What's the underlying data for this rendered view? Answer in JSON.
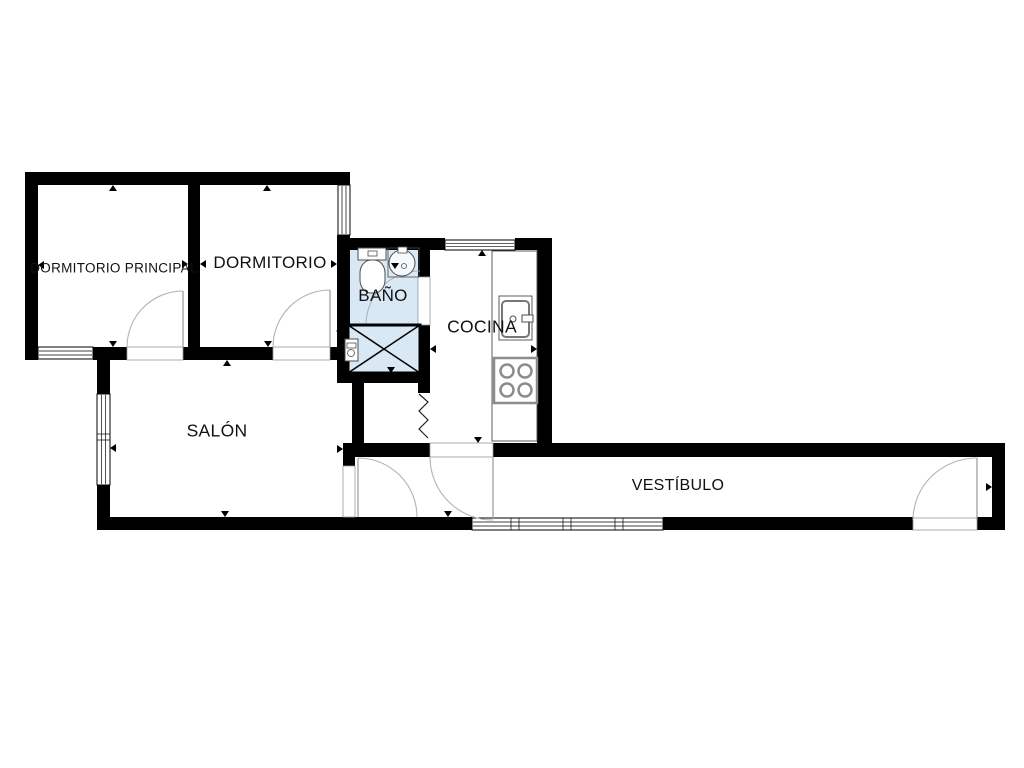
{
  "page": {
    "background": "#ffffff"
  },
  "rooms": [
    {
      "id": "dormitorio-principal",
      "label": "DORMITORIO PRINCIPAL",
      "x": 114,
      "y": 268,
      "font_size": 13.5
    },
    {
      "id": "dormitorio",
      "label": "DORMITORIO",
      "x": 270,
      "y": 263,
      "font_size": 17
    },
    {
      "id": "bano",
      "label": "BAÑO",
      "x": 383,
      "y": 296,
      "font_size": 17
    },
    {
      "id": "cocina",
      "label": "COCINA",
      "x": 482,
      "y": 327,
      "font_size": 17.5
    },
    {
      "id": "salon",
      "label": "SALÓN",
      "x": 217,
      "y": 431,
      "font_size": 17.5
    },
    {
      "id": "vestibulo",
      "label": "VESTÍBULO",
      "x": 678,
      "y": 486,
      "font_size": 16
    }
  ],
  "colors": {
    "wall": "#000000",
    "bath_fill": "#d9e8f5",
    "arc": "#b3b3b3",
    "leaf": "#9a9a9a",
    "fixture": "#4d4d4d",
    "appliance": "#8c8c8c",
    "threshold": "#999999",
    "text": "#111111"
  },
  "floorplan": {
    "width": 1024,
    "height": 768,
    "fills": [
      {
        "x": 347,
        "y": 249,
        "w": 72,
        "h": 125,
        "color": "#d9e8f5",
        "name": "bathroom-floor"
      }
    ],
    "walls": [
      [
        25,
        172,
        325,
        13
      ],
      [
        25,
        172,
        13,
        188
      ],
      [
        25,
        347,
        13,
        13
      ],
      [
        93,
        347,
        34,
        13
      ],
      [
        183,
        347,
        90,
        13
      ],
      [
        330,
        347,
        20,
        13
      ],
      [
        188,
        180,
        12,
        175
      ],
      [
        337,
        235,
        13,
        15
      ],
      [
        337,
        238,
        108,
        12
      ],
      [
        515,
        238,
        37,
        12
      ],
      [
        337,
        250,
        13,
        133
      ],
      [
        418,
        250,
        12,
        27
      ],
      [
        418,
        325,
        12,
        68
      ],
      [
        337,
        373,
        93,
        10
      ],
      [
        352,
        383,
        12,
        74
      ],
      [
        343,
        443,
        87,
        14
      ],
      [
        343,
        443,
        12,
        24
      ],
      [
        493,
        443,
        59,
        14
      ],
      [
        537,
        238,
        15,
        219
      ],
      [
        537,
        443,
        468,
        14
      ],
      [
        992,
        443,
        13,
        87
      ],
      [
        97,
        517,
        375,
        13
      ],
      [
        663,
        517,
        250,
        13
      ],
      [
        977,
        517,
        28,
        13
      ],
      [
        97,
        347,
        13,
        47
      ],
      [
        97,
        485,
        13,
        45
      ]
    ],
    "thresholds": [
      [
        127,
        347,
        56,
        13
      ],
      [
        273,
        347,
        57,
        13
      ],
      [
        418,
        277,
        12,
        48
      ],
      [
        343,
        466,
        12,
        51
      ],
      [
        430,
        443,
        63,
        14
      ],
      [
        913,
        518,
        64,
        12
      ]
    ],
    "windows": [
      {
        "x": 38,
        "y": 347,
        "w": 55,
        "h": 12,
        "o": "h",
        "divs": []
      },
      {
        "x": 338,
        "y": 185,
        "w": 12,
        "h": 50,
        "o": "v",
        "divs": []
      },
      {
        "x": 97,
        "y": 394,
        "w": 13,
        "h": 91,
        "o": "v",
        "divs": [
          437
        ]
      },
      {
        "x": 445,
        "y": 240,
        "w": 70,
        "h": 10,
        "o": "h",
        "divs": []
      },
      {
        "x": 472,
        "y": 518,
        "w": 191,
        "h": 12,
        "o": "h",
        "divs": [
          515,
          567,
          619
        ]
      }
    ],
    "doors": [
      {
        "name": "door-dormitorio-principal",
        "leaf": [
          183,
          291,
          183,
          347
        ],
        "arc": "M127,347 A56,56 0 0 1 183,291"
      },
      {
        "name": "door-dormitorio",
        "leaf": [
          330,
          290,
          330,
          347
        ],
        "arc": "M273,347 A57,57 0 0 1 330,290"
      },
      {
        "name": "door-bano",
        "leaf": [
          366,
          325,
          420,
          325
        ],
        "arc": "M366,325 A54,54 0 0 1 420,271"
      },
      {
        "name": "door-salon",
        "leaf": [
          358,
          458,
          358,
          517
        ],
        "arc": "M358,458 A59,59 0 0 1 417,517"
      },
      {
        "name": "door-cocina",
        "leaf": [
          493,
          457,
          493,
          519
        ],
        "arc": "M430,457 A63,63 0 0 0 493,520"
      },
      {
        "name": "door-entrada",
        "leaf": [
          977,
          458,
          977,
          520
        ],
        "arc": "M913,520 A64,62 0 0 1 977,458"
      }
    ],
    "zigzag": {
      "points": "419,394 428,402 419,411 428,420 419,429 428,438",
      "stroke": "#222222"
    },
    "markers": [
      [
        113,
        185,
        "up"
      ],
      [
        267,
        185,
        "up"
      ],
      [
        38,
        265,
        "left"
      ],
      [
        188,
        264,
        "right"
      ],
      [
        200,
        264,
        "left"
      ],
      [
        337,
        264,
        "right"
      ],
      [
        113,
        347,
        "down"
      ],
      [
        268,
        347,
        "down"
      ],
      [
        227,
        360,
        "up"
      ],
      [
        225,
        517,
        "down"
      ],
      [
        110,
        448,
        "left"
      ],
      [
        343,
        449,
        "right"
      ],
      [
        395,
        269,
        "down"
      ],
      [
        391,
        373,
        "down"
      ],
      [
        336,
        331,
        "left"
      ],
      [
        482,
        250,
        "up"
      ],
      [
        537,
        349,
        "right"
      ],
      [
        430,
        349,
        "left"
      ],
      [
        478,
        443,
        "down"
      ],
      [
        448,
        517,
        "down"
      ],
      [
        992,
        487,
        "right"
      ]
    ],
    "fixtures": {
      "toilet": {
        "tank": [
          358,
          248,
          28,
          12
        ],
        "button": [
          368,
          251,
          9,
          5
        ],
        "bowl": [
          360,
          260,
          25,
          33
        ]
      },
      "bath_sink": {
        "counter": [
          388,
          248,
          31,
          29
        ],
        "basin_c": [
          402,
          263
        ],
        "basin_r": 13,
        "drain_c": [
          404,
          266
        ],
        "drain_r": 2.5,
        "tap": [
          398,
          247,
          9,
          6
        ]
      },
      "shower": {
        "tray": [
          348,
          325,
          72,
          48
        ],
        "valve": [
          345,
          339,
          13,
          22
        ],
        "valve_top": [
          347,
          343,
          9,
          5
        ],
        "valve_knob": [
          351,
          353,
          3.5
        ]
      },
      "counter": [
        492,
        251,
        45,
        190
      ],
      "kitchen_sink": {
        "outer": [
          499,
          296,
          33,
          44
        ],
        "basin": [
          502,
          301,
          27,
          36
        ],
        "drain_c": [
          513,
          319
        ],
        "drain_r": 3,
        "tap": [
          522,
          315,
          11,
          7
        ]
      },
      "stove": {
        "body": [
          494,
          358,
          43,
          45
        ],
        "burner_r": 6.5,
        "burners": [
          [
            507,
            371
          ],
          [
            525,
            371
          ],
          [
            507,
            390
          ],
          [
            525,
            390
          ]
        ]
      }
    }
  }
}
